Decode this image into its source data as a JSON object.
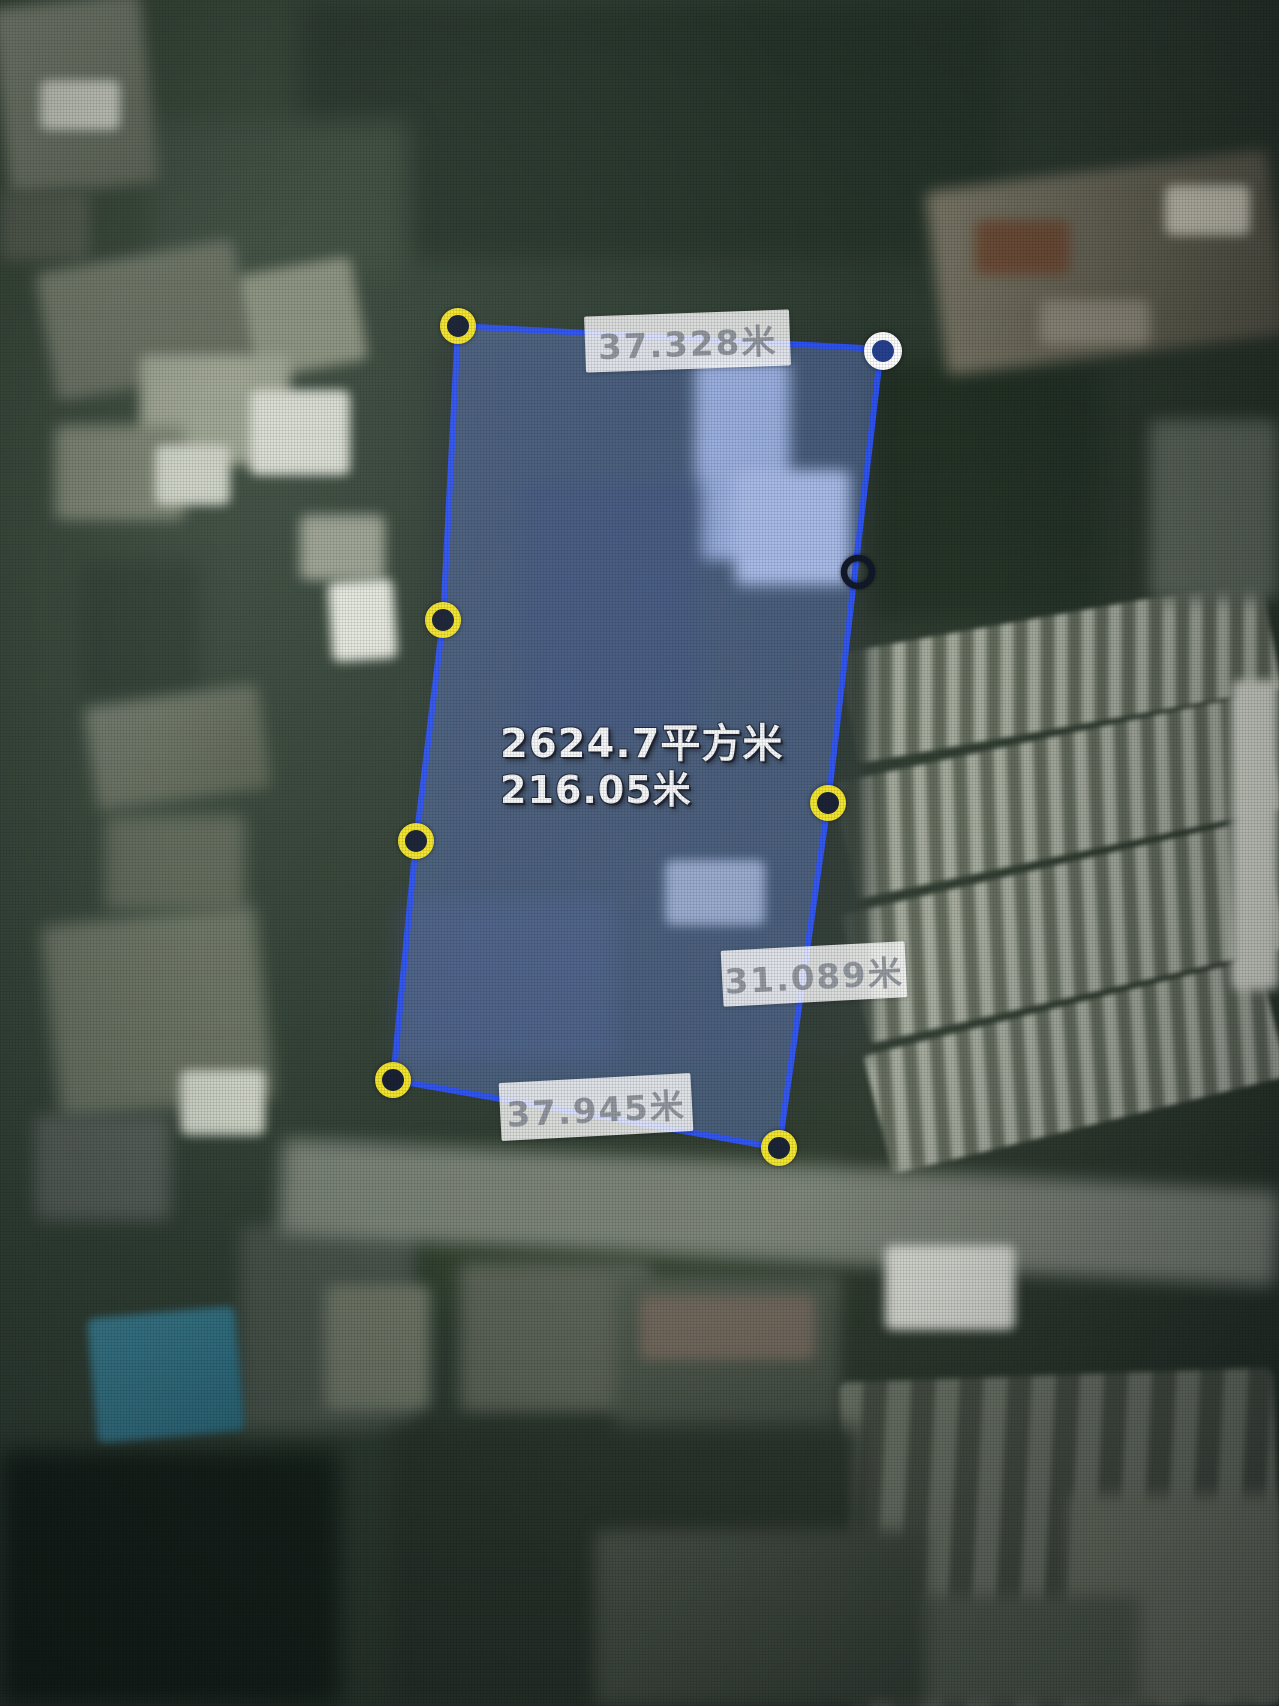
{
  "map": {
    "description": "satellite basemap with land parcel measurement overlay",
    "center_annotation": {
      "area_text": "2624.7平方米",
      "perimeter_text": "216.05米"
    },
    "edge_labels": {
      "top": "37.328米",
      "right": "31.089米",
      "bottom": "37.945米"
    },
    "overlay_colors": {
      "polygon_stroke": "#2b51f2",
      "polygon_fill": "rgba(104,141,227,0.40)",
      "vertex_yellow": "#f2e428",
      "vertex_white": "#ffffff",
      "vertex_black": "#0c1426",
      "label_background": "rgba(255,255,255,0.82)",
      "label_text": "#8f949c",
      "annotation_text": "#f4f6f8"
    },
    "vertices": [
      {
        "name": "top-left",
        "style": "yellow",
        "x": 458,
        "y": 326
      },
      {
        "name": "top-right",
        "style": "white",
        "x": 883,
        "y": 351
      },
      {
        "name": "right-upper-handle",
        "style": "black",
        "x": 858,
        "y": 572
      },
      {
        "name": "right-mid",
        "style": "yellow",
        "x": 828,
        "y": 803
      },
      {
        "name": "bottom-right",
        "style": "yellow",
        "x": 779,
        "y": 1148
      },
      {
        "name": "bottom-left",
        "style": "yellow",
        "x": 393,
        "y": 1080
      },
      {
        "name": "left-lower",
        "style": "yellow",
        "x": 416,
        "y": 841
      },
      {
        "name": "left-upper",
        "style": "yellow",
        "x": 443,
        "y": 620
      }
    ]
  }
}
